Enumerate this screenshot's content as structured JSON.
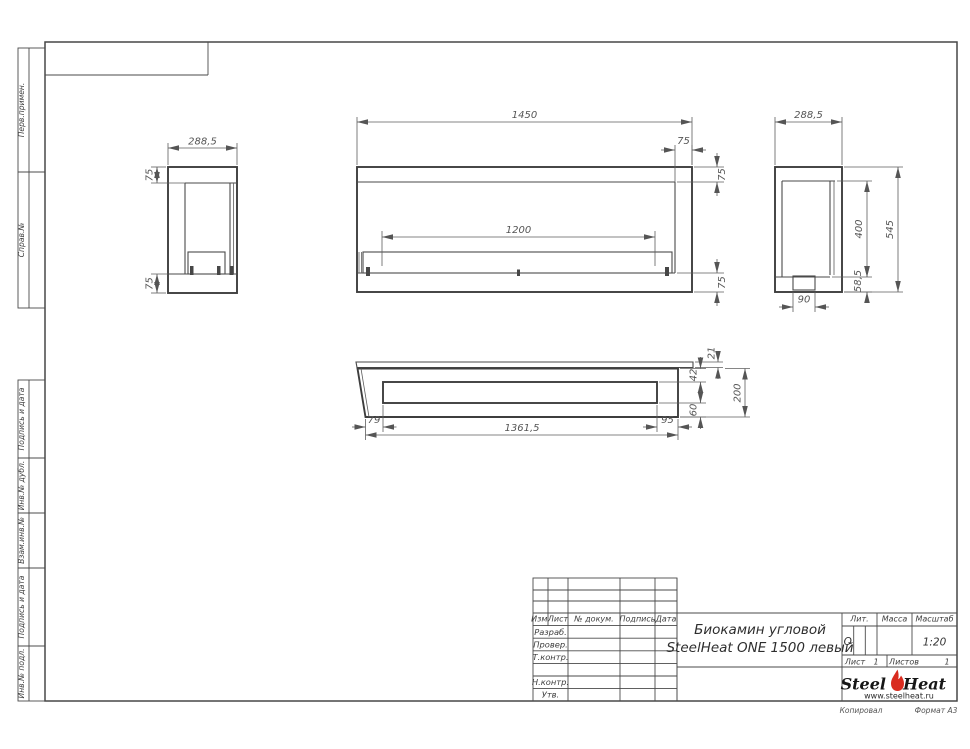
{
  "colors": {
    "line": "#4a4a4a",
    "dim_text": "#555555",
    "flame_red": "#d92b1f"
  },
  "sidebar": {
    "labels": [
      "Перв.примен.",
      "Справ.№",
      "Подпись и дата",
      "Инв.№ дубл.",
      "Взам.инв.№",
      "Подпись и дата",
      "Инв.№ подл."
    ]
  },
  "title_block": {
    "doc_title_line1": "Биокамин угловой",
    "doc_title_line2": "SteelHeat ONE 1500 левый",
    "col_izm": "Изм.",
    "col_list": "Лист",
    "col_doc": "№ докум.",
    "col_sign": "Подпись",
    "col_date": "Дата",
    "row_razrab": "Разраб.",
    "row_prover": "Провер.",
    "row_tkontr": "Т.контр.",
    "row_nkontr": "Н.контр.",
    "row_utv": "Утв.",
    "lit_label": "Лит.",
    "lit_value": "О",
    "massa_label": "Масса",
    "scale_label": "Масштаб",
    "scale_value": "1:20",
    "sheet_label": "Лист",
    "sheet_value": "1",
    "sheets_label": "Листов",
    "sheets_value": "1"
  },
  "logo": {
    "steel": "Steel",
    "heat": "Heat",
    "url": "www.steelheat.ru"
  },
  "footer": {
    "copied": "Копировал",
    "format": "Формат А3"
  },
  "views": {
    "left_side": {
      "width": "288,5",
      "top_offset": "75",
      "bottom_offset": "75"
    },
    "front": {
      "width": "1450",
      "burner_length": "1200",
      "corner_inset": "75",
      "top_inset": "75",
      "bottom_inset": "75"
    },
    "right_side": {
      "depth": "288,5",
      "opening_height": "400",
      "height": "545",
      "base_height": "58,5",
      "burner_width": "90"
    },
    "top": {
      "left_offset": "79",
      "body_length": "1361,5",
      "right_offset": "95",
      "lip": "21",
      "front_inset": "42",
      "back_inset": "60",
      "depth": "200"
    }
  }
}
